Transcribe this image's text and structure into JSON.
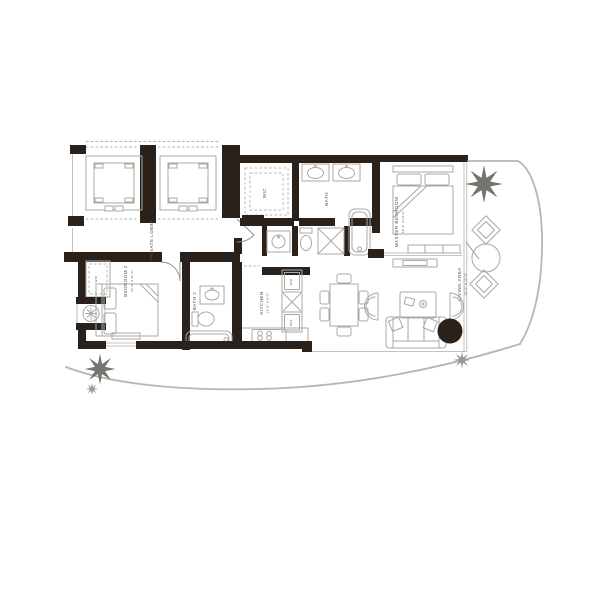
{
  "colors": {
    "wall": "#2a211b",
    "fixture_line": "#a8a8a5",
    "terrace_line": "#b5b5b2",
    "text": "#55504c",
    "plant": "#75756e"
  },
  "rooms": {
    "private_lobby": {
      "label": "PRIVATE LOBBY"
    },
    "walk_in_closet": {
      "label": "WIC"
    },
    "master_bath": {
      "label": "BATH"
    },
    "master_bedroom": {
      "label": "MASTER BEDROOM",
      "dimensions": "12'-4\" X 13'-0\""
    },
    "living_area": {
      "label": "LIVING AREA",
      "dimensions": "20'-0\" X 12'-6\""
    },
    "kitchen": {
      "label": "KITCHEN",
      "dimensions": "12'-6\" X 9'-0\""
    },
    "bedroom_2": {
      "label": "BEDROOM 2",
      "dimensions": "12'-0\" X 11'-6\""
    },
    "bath_2": {
      "label": "BATH 2"
    },
    "bedroom_2_closet": {
      "label": "WIC"
    }
  },
  "appliances": {
    "washer_dryer": "W/D",
    "refrigerator": "REF"
  }
}
